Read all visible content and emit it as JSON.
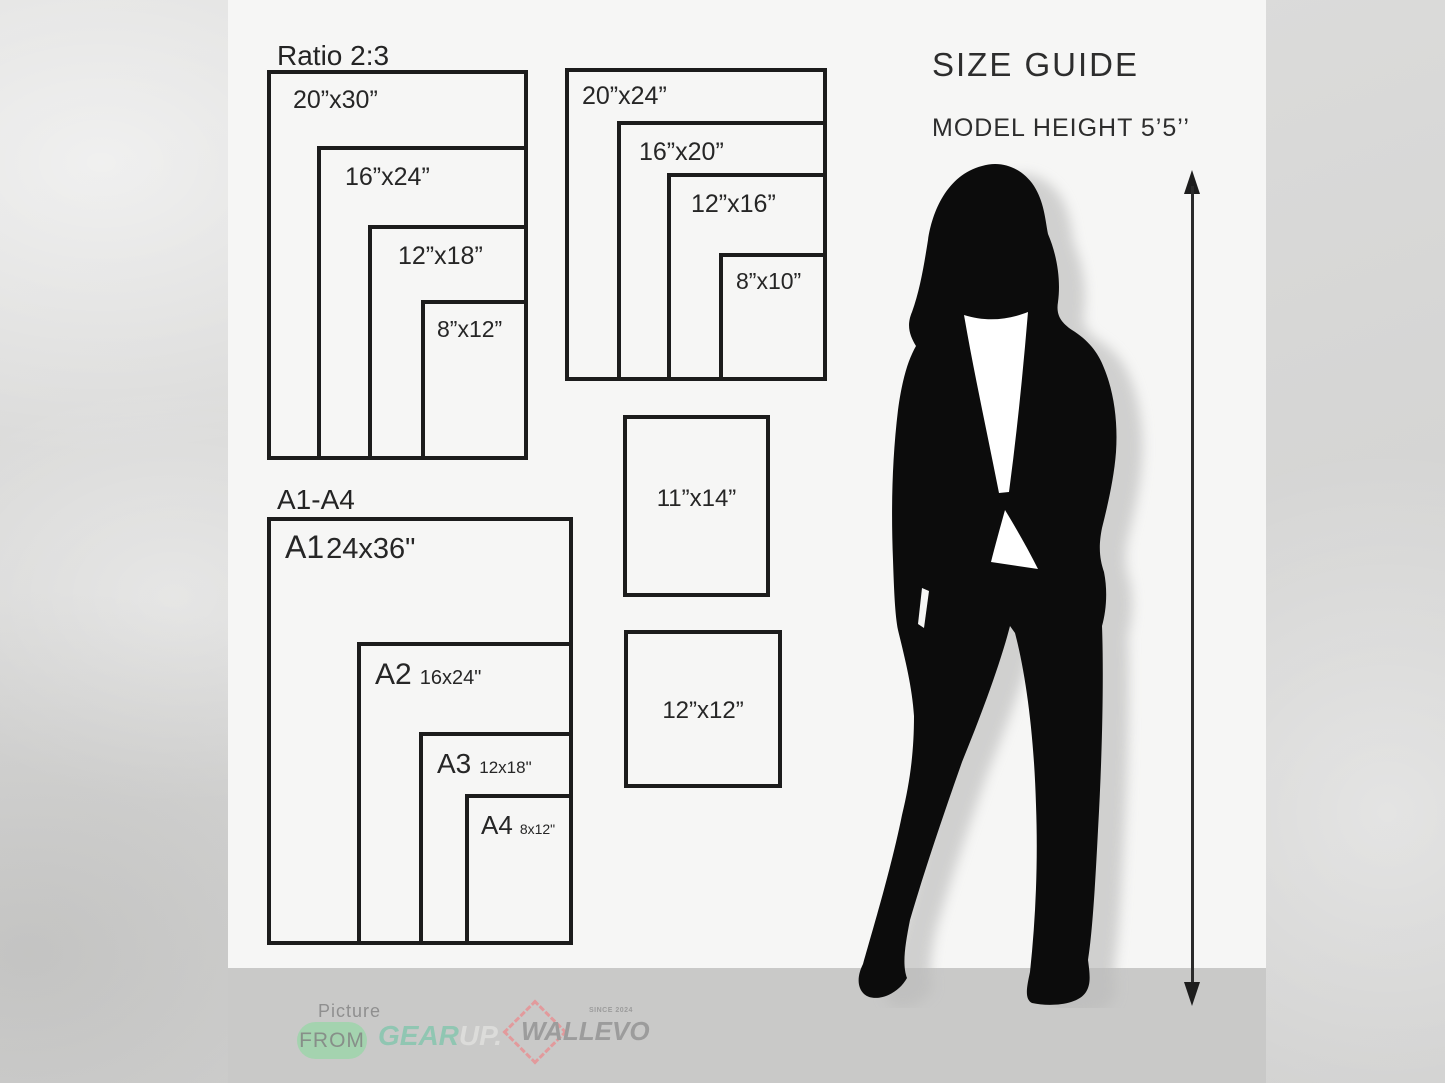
{
  "header": {
    "size_guide": "SIZE GUIDE",
    "model_height": "MODEL HEIGHT 5’5’’"
  },
  "groups": {
    "ratio23": {
      "title": "Ratio 2:3",
      "sizes": [
        "20”x30”",
        "16”x24”",
        "12”x18”",
        "8”x12”"
      ]
    },
    "ratio45": {
      "sizes": [
        "20”x24”",
        "16”x20”",
        "12”x16”",
        "8”x10”"
      ]
    },
    "a_series": {
      "title": "A1-A4",
      "items": [
        {
          "name": "A1",
          "size": "24x36\""
        },
        {
          "name": "A2",
          "size": "16x24\""
        },
        {
          "name": "A3",
          "size": "12x18\""
        },
        {
          "name": "A4",
          "size": "8x12\""
        }
      ]
    },
    "singles": [
      "11”x14”",
      "12”x12”"
    ]
  },
  "footer": {
    "picture_label": "Picture",
    "from_label": "FROM",
    "gear": "GEAR",
    "up": "UP.",
    "wallevo": "WALLEVO",
    "since": "SINCE 2024"
  },
  "colors": {
    "panel_bg": "#f6f6f5",
    "outer_bg": "#d6d6d5",
    "footer_bar": "#c9c9c8",
    "box_border": "#1c1c1c",
    "pill_green": "#a4d3af",
    "gear_teal": "#90c6b2",
    "diamond_red": "#e29a9c",
    "logo_gray": "#9c9c9c"
  }
}
